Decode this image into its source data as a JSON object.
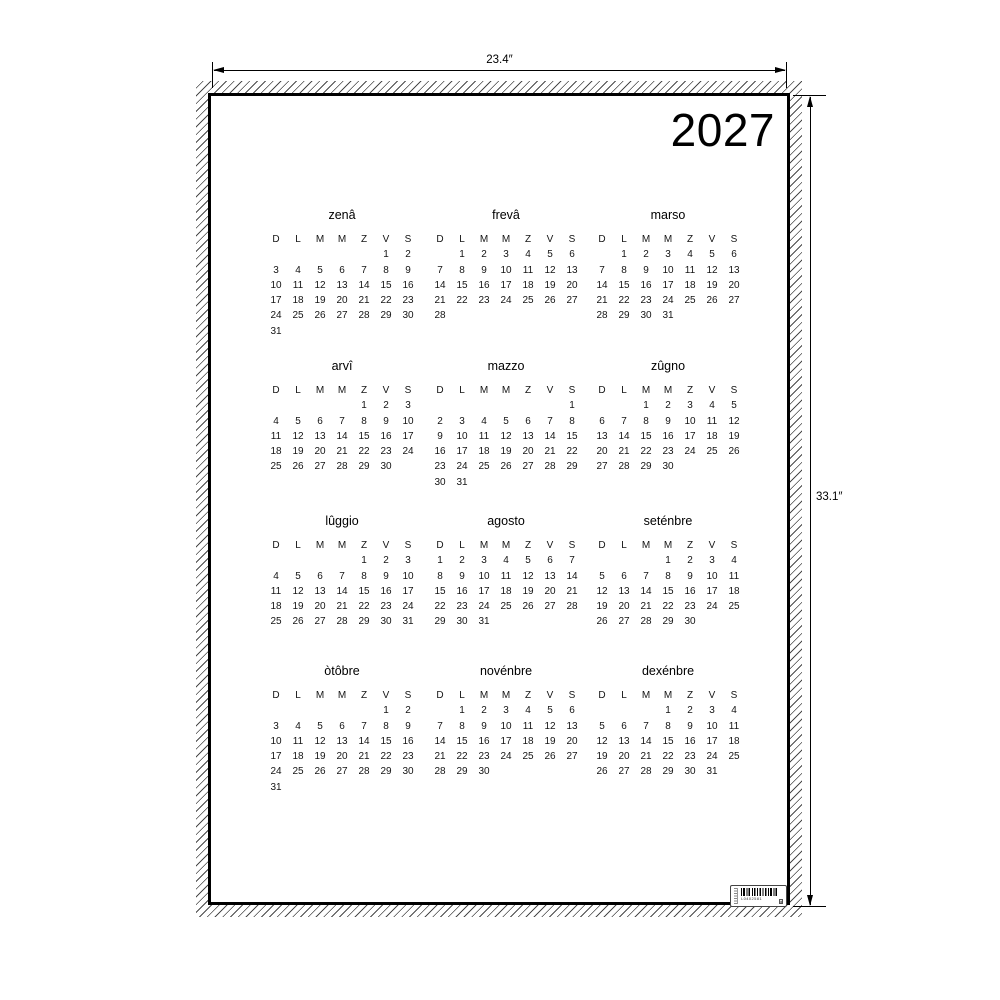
{
  "poster": {
    "year": "2027",
    "weekday_headers": [
      "D",
      "L",
      "M",
      "M",
      "Z",
      "V",
      "S"
    ],
    "months": [
      {
        "name": "zenâ",
        "start_dow": 5,
        "days": 31
      },
      {
        "name": "frevâ",
        "start_dow": 1,
        "days": 28
      },
      {
        "name": "marso",
        "start_dow": 1,
        "days": 31
      },
      {
        "name": "arvî",
        "start_dow": 4,
        "days": 30
      },
      {
        "name": "mazzo",
        "start_dow": 6,
        "days": 31
      },
      {
        "name": "zûgno",
        "start_dow": 2,
        "days": 30
      },
      {
        "name": "lûggio",
        "start_dow": 4,
        "days": 31
      },
      {
        "name": "agosto",
        "start_dow": 0,
        "days": 31
      },
      {
        "name": "seténbre",
        "start_dow": 3,
        "days": 30
      },
      {
        "name": "òtôbre",
        "start_dow": 5,
        "days": 31
      },
      {
        "name": "novénbre",
        "start_dow": 1,
        "days": 30
      },
      {
        "name": "dexénbre",
        "start_dow": 3,
        "days": 31
      }
    ]
  },
  "dimensions": {
    "width_label": "23.4″",
    "height_label": "33.1″"
  },
  "barcode": {
    "code": "L0402581"
  },
  "colors": {
    "ink": "#000000",
    "paper": "#ffffff",
    "hatch": "#4a4a4a"
  }
}
